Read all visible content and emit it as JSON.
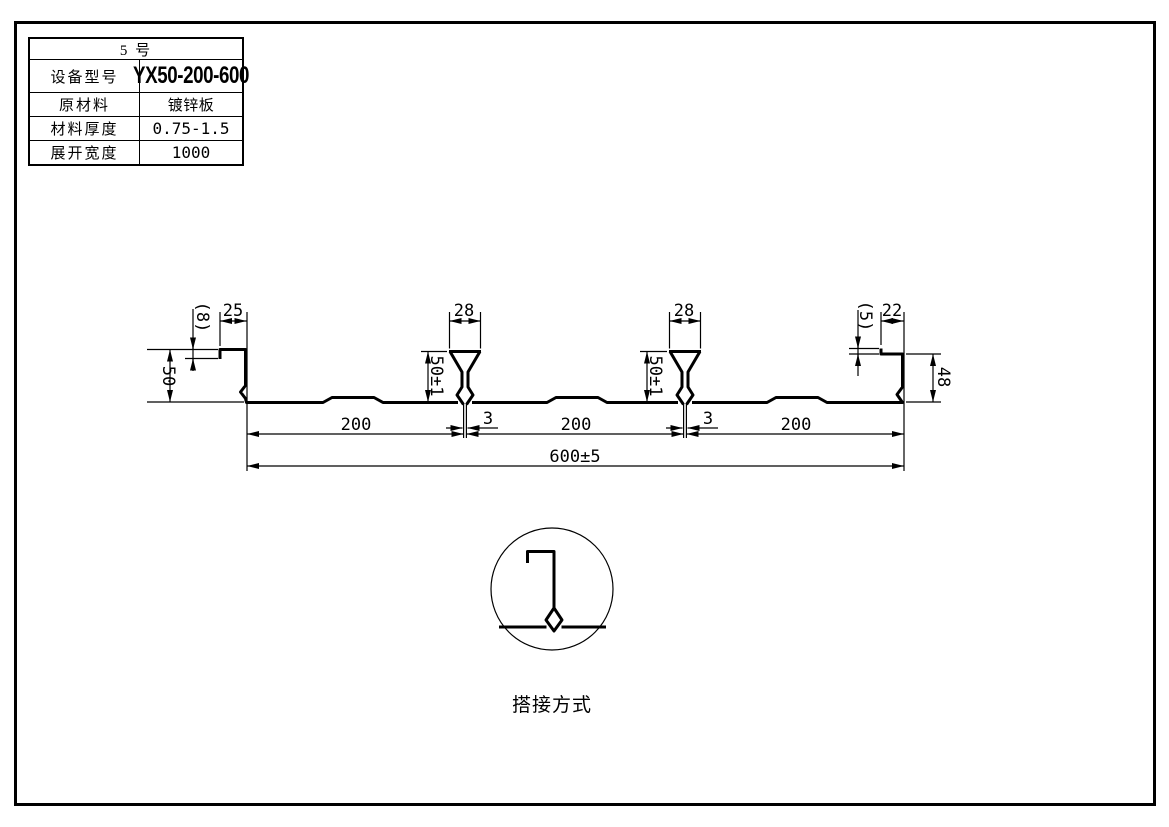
{
  "sheet": {
    "background": "#ffffff",
    "line_color": "#000000"
  },
  "spec_table": {
    "title": "5 号",
    "rows": [
      {
        "label": "设备型号",
        "value": "YX50-200-600"
      },
      {
        "label": "原材料",
        "value": "镀锌板"
      },
      {
        "label": "材料厚度",
        "value": "0.75-1.5"
      },
      {
        "label": "展开宽度",
        "value": "1000"
      }
    ]
  },
  "profile_dims": {
    "left_edge_lip": "(8)",
    "left_edge_top": "25",
    "left_edge_height": "50",
    "rib_width": [
      "28",
      "28"
    ],
    "rib_height": [
      "50±1",
      "50±1"
    ],
    "rib_slot": [
      "3",
      "3"
    ],
    "right_edge_lip": "(5)",
    "right_edge_top": "22",
    "right_edge_height": "48",
    "pitch": [
      "200",
      "200",
      "200"
    ],
    "overall_width": "600±5"
  },
  "lap_detail": {
    "label": "搭接方式"
  }
}
